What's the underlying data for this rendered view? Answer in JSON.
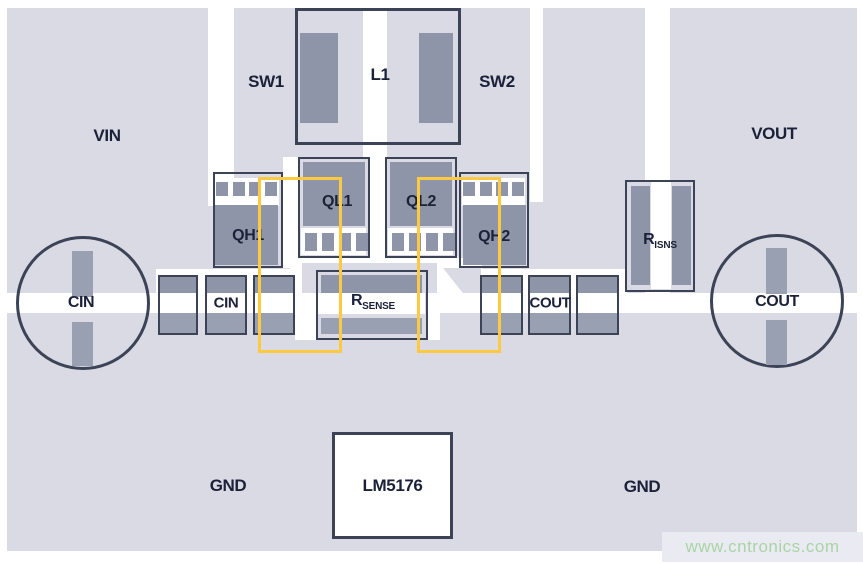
{
  "diagram": {
    "region_labels": {
      "vin": "VIN",
      "vout": "VOUT",
      "sw1": "SW1",
      "sw2": "SW2",
      "gnd_left": "GND",
      "gnd_right": "GND"
    },
    "components": {
      "l1": {
        "label": "L1"
      },
      "qh1": {
        "label": "QH1"
      },
      "ql1": {
        "label": "QL1"
      },
      "ql2": {
        "label": "QL2"
      },
      "qh2": {
        "label": "QH2"
      },
      "cin_bulk": {
        "label": "CIN"
      },
      "cin_ceramic": {
        "label": "CIN"
      },
      "rsense": {
        "base": "R",
        "sub": "SENSE"
      },
      "cout_ceramic": {
        "label": "COUT"
      },
      "cout_bulk": {
        "label": "COUT"
      },
      "risns": {
        "base": "R",
        "sub": "ISNS"
      },
      "ic": {
        "label": "LM5176"
      }
    },
    "colors": {
      "board": "#d9dae3",
      "pad": "#8e95a8",
      "pad2": "#99a0b1",
      "line": "#3c4357",
      "ink": "#1b2138",
      "yellow": "#fcc940",
      "green": "#a9d4a6",
      "wmbg": "#eaebf2"
    }
  },
  "watermark": {
    "text": "www.cntronics.com"
  }
}
